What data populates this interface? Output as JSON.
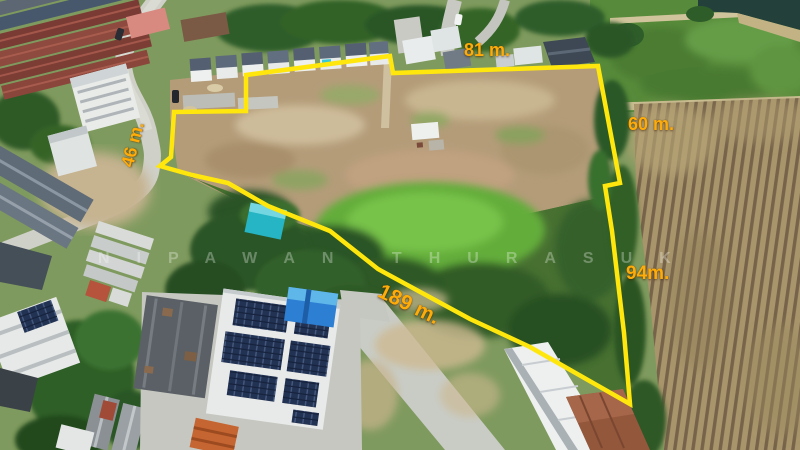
{
  "watermark": {
    "text": "NIPAWAN THURASUK"
  },
  "boundary": {
    "color": "#FFE70D",
    "label_color": "#FFAC08",
    "measurements": {
      "top": "81 m.",
      "right_upper": "60 m.",
      "right_lower": "94m.",
      "bottom": "189 m.",
      "left": "46 m."
    }
  }
}
